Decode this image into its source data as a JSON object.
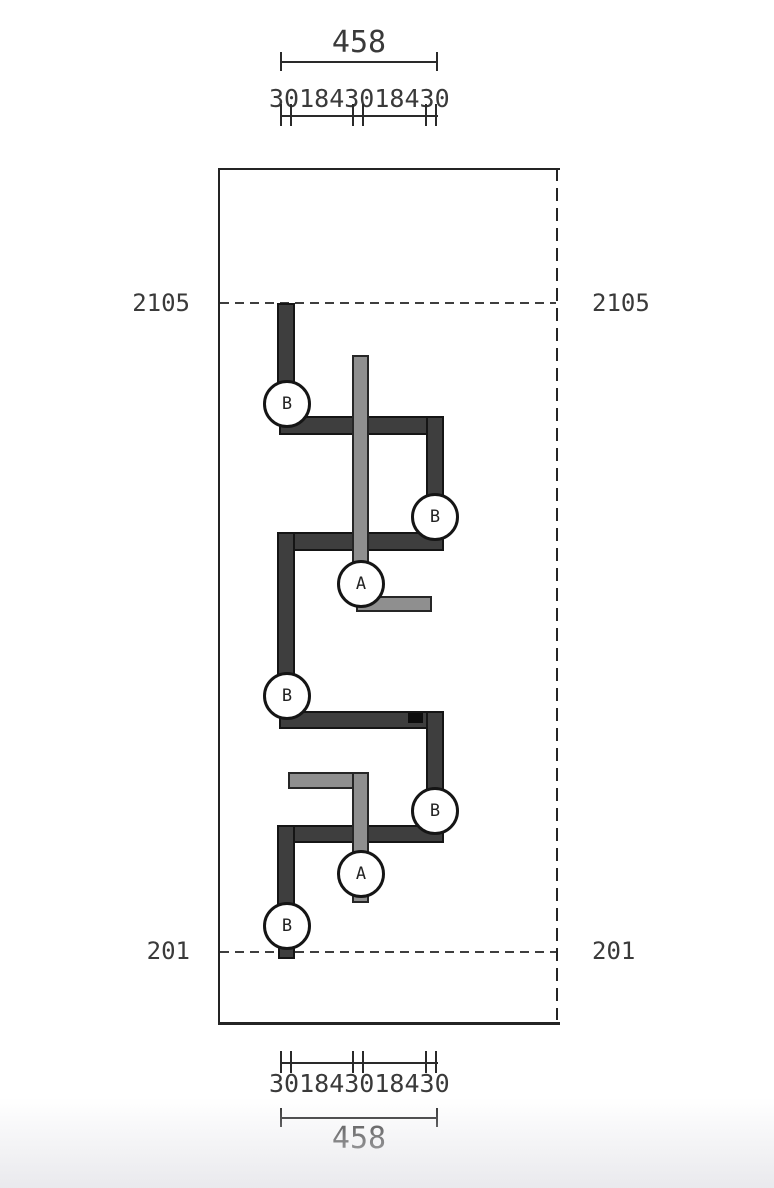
{
  "levels": {
    "upper": "2105",
    "lower": "201"
  },
  "dimensions": {
    "top": {
      "total": "458",
      "segments": [
        "30",
        "184",
        "30",
        "184",
        "30"
      ],
      "segments_text": "301843018430"
    },
    "bottom": {
      "total": "458",
      "segments": [
        "30",
        "184",
        "30",
        "184",
        "30"
      ],
      "segments_text": "301843018430"
    }
  },
  "callouts": [
    {
      "id": "B1",
      "label": "B"
    },
    {
      "id": "B2",
      "label": "B"
    },
    {
      "id": "A1",
      "label": "A"
    },
    {
      "id": "B3",
      "label": "B"
    },
    {
      "id": "B4",
      "label": "B"
    },
    {
      "id": "A2",
      "label": "A"
    },
    {
      "id": "B5",
      "label": "B"
    }
  ],
  "colors": {
    "dark_bar": "#3e3e3e",
    "light_bar": "#8f8f8f",
    "outline": "#151515",
    "line": "#2a2a2a",
    "background": "#ffffff"
  }
}
